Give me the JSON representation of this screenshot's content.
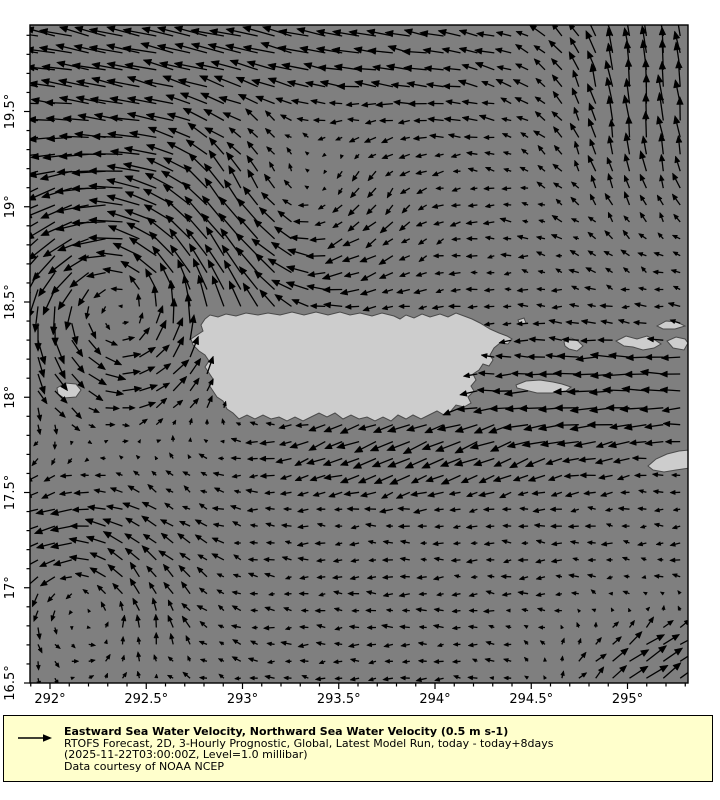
{
  "window": {
    "background": "#ffffff"
  },
  "map": {
    "region": "Puerto Rico and Virgin Islands",
    "ocean_color": "#7f7f7f",
    "land_color": "#cdcdcd",
    "coast_color": "#4a4a4a",
    "arrow_color": "#000000",
    "frame": {
      "left": 30,
      "top": 25,
      "width": 658,
      "height": 658
    }
  },
  "axes": {
    "x_scale": {
      "lon0": 292,
      "x0": 50,
      "px_per_deg": 192.5
    },
    "y_scale": {
      "lat0": 16.5,
      "y0": 683,
      "px_per_deg": 190.5
    },
    "x_ticks": [
      {
        "lon": 292,
        "label": "292°"
      },
      {
        "lon": 292.5,
        "label": "292.5°"
      },
      {
        "lon": 293,
        "label": "293°"
      },
      {
        "lon": 293.5,
        "label": "293.5°"
      },
      {
        "lon": 294,
        "label": "294°"
      },
      {
        "lon": 294.5,
        "label": "294.5°"
      },
      {
        "lon": 295,
        "label": "295°"
      }
    ],
    "y_ticks": [
      {
        "lat": 16.5,
        "label": "16.5°"
      },
      {
        "lat": 17,
        "label": "17°"
      },
      {
        "lat": 17.5,
        "label": "17.5°"
      },
      {
        "lat": 18,
        "label": "18°"
      },
      {
        "lat": 18.5,
        "label": "18.5°"
      },
      {
        "lat": 19,
        "label": "19°"
      },
      {
        "lat": 19.5,
        "label": "19.5°"
      }
    ],
    "minor_step_deg": 0.1,
    "minor_lon_range": [
      291.9,
      295.3
    ],
    "minor_lat_range": [
      16.5,
      19.9
    ]
  },
  "legend": {
    "title": "Eastward Sea Water Velocity, Northward Sea Water Velocity (0.5 m s-1)",
    "line2": "RTOFS Forecast, 2D, 3-Hourly Prognostic, Global, Latest Model Run, today - today+8days",
    "line3": "(2025-11-22T03:00:00Z, Level=1.0 millibar)",
    "line4": "Data courtesy of NOAA NCEP",
    "background": "#ffffcc",
    "border": "#000000"
  },
  "chart_data": {
    "type": "quiver",
    "title": "Eastward Sea Water Velocity, Northward Sea Water Velocity",
    "units": "m s-1",
    "reference_vector_m_s": 0.5,
    "lon_range_deg_east": [
      291.9,
      295.31
    ],
    "lat_range_deg_north": [
      16.5,
      19.95
    ],
    "grid": {
      "cols": 39,
      "rows": 39,
      "x0": 38,
      "y0": 36,
      "step": 16.9
    },
    "scale_px_per_m_s": 40,
    "max_arrow_px": 34,
    "flow_features": [
      {
        "name": "westward-jet",
        "where": "north of 19.6N across top of domain",
        "speed_m_s": 0.8,
        "direction": "W-NW"
      },
      {
        "name": "northward-flow",
        "where": "northeast corner near 295.2E 19.4-19.9N",
        "speed_m_s": 0.7,
        "direction": "N"
      },
      {
        "name": "cyclonic-eddy",
        "where": "Mona Passage area ~292.35E 18.55N",
        "speed_m_s": 0.6,
        "sense": "counterclockwise"
      },
      {
        "name": "anticyclonic-eddy",
        "where": "~293.3E 18.95N north of Puerto Rico",
        "speed_m_s": 0.35,
        "sense": "clockwise"
      },
      {
        "name": "westward-band",
        "where": "east of Vieques ~295E 18.0-18.4N",
        "speed_m_s": 0.55,
        "direction": "W"
      },
      {
        "name": "southwestward-flow",
        "where": "along south coast of Puerto Rico",
        "speed_m_s": 0.5,
        "direction": "WSW"
      },
      {
        "name": "weak-cyclonic-eddy",
        "where": "southwest corner ~292.2E 17.0N",
        "speed_m_s": 0.3,
        "sense": "counterclockwise"
      },
      {
        "name": "northeastward-flow",
        "where": "southeast corner ~295.2E 16.6N",
        "speed_m_s": 0.55,
        "direction": "NE"
      },
      {
        "name": "weak-westward-drift",
        "where": "southern interior 16.6-17.6N",
        "speed_m_s": 0.2,
        "direction": "W"
      }
    ],
    "field_model": {
      "base_u": -0.22,
      "jet": {
        "y0": 38,
        "sy": 95,
        "x0": 200,
        "sx": 300,
        "u": -0.62,
        "v": -0.2
      },
      "ne_flow": {
        "x0": 650,
        "sx": 95,
        "y0": 85,
        "sy": 130,
        "u": 0.2,
        "v": -0.7
      },
      "eddies": [
        {
          "cx": 118,
          "cy": 295,
          "r": 115,
          "k": 1.0
        },
        {
          "cx": 300,
          "cy": 212,
          "r": 90,
          "k": -0.42
        },
        {
          "cx": 82,
          "cy": 592,
          "r": 95,
          "k": 0.5
        }
      ],
      "west_band": {
        "x0": 615,
        "sx": 130,
        "y0": 390,
        "sy": 55,
        "u": -0.42,
        "v": 0.0
      },
      "sw_band": {
        "x0": 420,
        "sx": 170,
        "y0": 448,
        "sy": 45,
        "u": -0.33,
        "v": 0.26
      },
      "br_flow": {
        "x0": 655,
        "sx": 95,
        "y0": 668,
        "sy": 55,
        "u": 0.75,
        "v": -0.35
      },
      "noise": 0.07
    },
    "islands": {
      "puerto_rico": [
        [
          205,
          319
        ],
        [
          210,
          315
        ],
        [
          218,
          317
        ],
        [
          226,
          314
        ],
        [
          236,
          316
        ],
        [
          246,
          313
        ],
        [
          258,
          315
        ],
        [
          268,
          313
        ],
        [
          280,
          315
        ],
        [
          292,
          312
        ],
        [
          304,
          315
        ],
        [
          316,
          312
        ],
        [
          328,
          315
        ],
        [
          340,
          312
        ],
        [
          350,
          315
        ],
        [
          360,
          313
        ],
        [
          372,
          316
        ],
        [
          382,
          313
        ],
        [
          394,
          316
        ],
        [
          400,
          319
        ],
        [
          406,
          315
        ],
        [
          414,
          318
        ],
        [
          422,
          314
        ],
        [
          430,
          317
        ],
        [
          440,
          314
        ],
        [
          448,
          317
        ],
        [
          456,
          313
        ],
        [
          464,
          316
        ],
        [
          472,
          319
        ],
        [
          480,
          323
        ],
        [
          490,
          329
        ],
        [
          499,
          333
        ],
        [
          507,
          336
        ],
        [
          512,
          339
        ],
        [
          508,
          344
        ],
        [
          500,
          343
        ],
        [
          494,
          348
        ],
        [
          490,
          355
        ],
        [
          493,
          360
        ],
        [
          489,
          366
        ],
        [
          483,
          364
        ],
        [
          479,
          370
        ],
        [
          473,
          374
        ],
        [
          476,
          380
        ],
        [
          471,
          386
        ],
        [
          474,
          391
        ],
        [
          468,
          397
        ],
        [
          471,
          403
        ],
        [
          464,
          407
        ],
        [
          456,
          405
        ],
        [
          451,
          411
        ],
        [
          444,
          415
        ],
        [
          437,
          411
        ],
        [
          429,
          415
        ],
        [
          421,
          419
        ],
        [
          413,
          415
        ],
        [
          406,
          419
        ],
        [
          398,
          415
        ],
        [
          391,
          421
        ],
        [
          383,
          417
        ],
        [
          375,
          421
        ],
        [
          367,
          417
        ],
        [
          359,
          419
        ],
        [
          351,
          415
        ],
        [
          343,
          419
        ],
        [
          335,
          413
        ],
        [
          327,
          417
        ],
        [
          319,
          413
        ],
        [
          311,
          417
        ],
        [
          303,
          421
        ],
        [
          295,
          417
        ],
        [
          287,
          421
        ],
        [
          279,
          417
        ],
        [
          271,
          419
        ],
        [
          263,
          415
        ],
        [
          255,
          419
        ],
        [
          247,
          415
        ],
        [
          239,
          419
        ],
        [
          233,
          413
        ],
        [
          227,
          409
        ],
        [
          223,
          401
        ],
        [
          217,
          397
        ],
        [
          213,
          391
        ],
        [
          209,
          385
        ],
        [
          213,
          379
        ],
        [
          209,
          373
        ],
        [
          205,
          367
        ],
        [
          209,
          361
        ],
        [
          205,
          355
        ],
        [
          199,
          351
        ],
        [
          193,
          345
        ],
        [
          191,
          339
        ],
        [
          197,
          335
        ],
        [
          203,
          331
        ],
        [
          201,
          325
        ]
      ],
      "mona": [
        [
          57,
          388
        ],
        [
          65,
          383
        ],
        [
          76,
          384
        ],
        [
          81,
          390
        ],
        [
          76,
          397
        ],
        [
          64,
          398
        ],
        [
          58,
          394
        ]
      ],
      "vieques": [
        [
          516,
          385
        ],
        [
          526,
          381
        ],
        [
          540,
          380
        ],
        [
          553,
          382
        ],
        [
          562,
          384
        ],
        [
          571,
          387
        ],
        [
          566,
          391
        ],
        [
          552,
          393
        ],
        [
          537,
          393
        ],
        [
          525,
          390
        ],
        [
          517,
          388
        ]
      ],
      "culebra": [
        [
          564,
          342
        ],
        [
          571,
          338
        ],
        [
          578,
          341
        ],
        [
          583,
          346
        ],
        [
          577,
          351
        ],
        [
          569,
          349
        ],
        [
          565,
          346
        ]
      ],
      "culebrita": [
        [
          518,
          320
        ],
        [
          524,
          318
        ],
        [
          526,
          323
        ],
        [
          520,
          325
        ]
      ],
      "st_thomas": [
        [
          616,
          341
        ],
        [
          626,
          336
        ],
        [
          637,
          339
        ],
        [
          647,
          336
        ],
        [
          655,
          340
        ],
        [
          661,
          344
        ],
        [
          654,
          348
        ],
        [
          643,
          350
        ],
        [
          633,
          347
        ],
        [
          624,
          346
        ]
      ],
      "tortola": [
        [
          667,
          341
        ],
        [
          676,
          337
        ],
        [
          685,
          339
        ],
        [
          688,
          343
        ],
        [
          684,
          350
        ],
        [
          673,
          348
        ]
      ],
      "anegada_sliver": [
        [
          657,
          326
        ],
        [
          666,
          321
        ],
        [
          677,
          322
        ],
        [
          685,
          326
        ],
        [
          675,
          329
        ],
        [
          663,
          329
        ]
      ],
      "st_croix": [
        [
          648,
          466
        ],
        [
          656,
          459
        ],
        [
          667,
          454
        ],
        [
          679,
          451
        ],
        [
          690,
          450
        ],
        [
          690,
          468
        ],
        [
          676,
          470
        ],
        [
          664,
          472
        ],
        [
          653,
          470
        ]
      ]
    }
  }
}
